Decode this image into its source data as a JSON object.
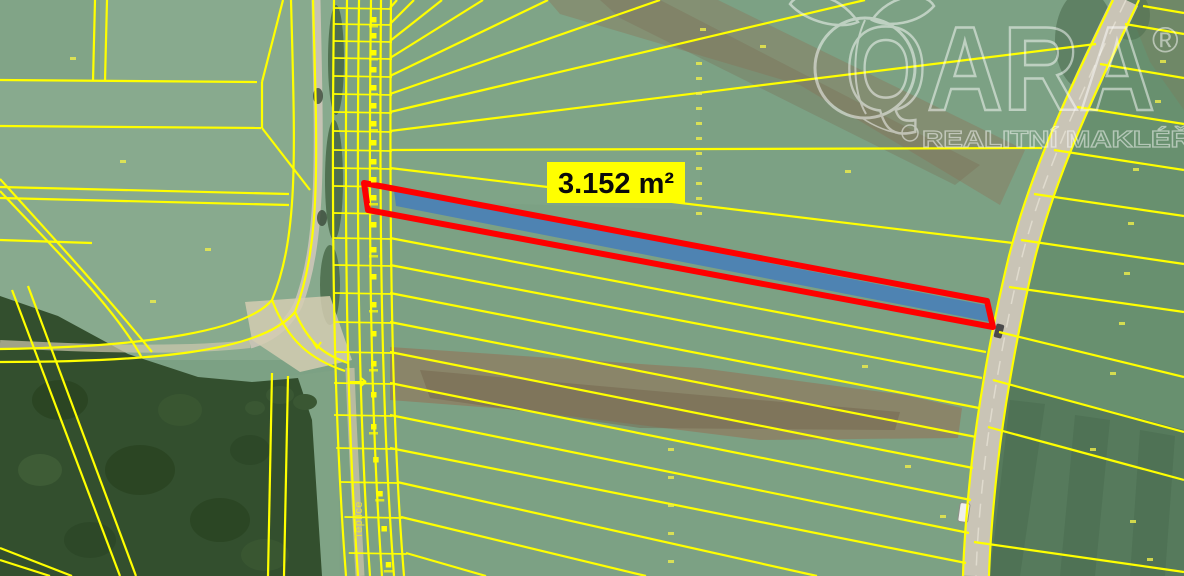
{
  "map_overlay": {
    "area_label": "3.152 m²",
    "road_label": "Teplice"
  },
  "watermark": {
    "wordmark": "QARA",
    "registered_mark": "®",
    "subtitle": "REALITNÍ MAKLÉŘI"
  },
  "legend_colors": {
    "parcel_boundary": "#ffff00",
    "highlight_outline": "#fe0000",
    "highlight_fill": "#4c82b4",
    "area_label_bg": "#ffff00",
    "area_label_text": "#0a0a0a"
  }
}
